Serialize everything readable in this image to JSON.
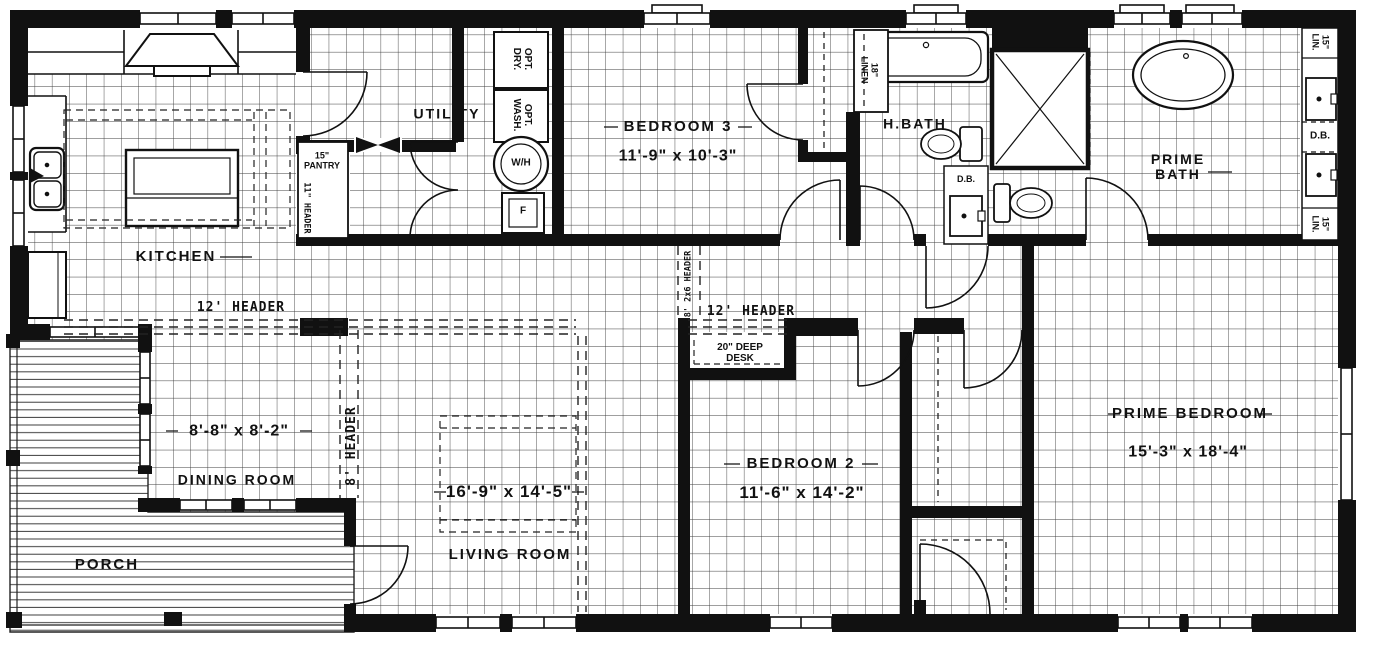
{
  "drawing": {
    "type": "manufactured-home floor plan",
    "line_color": "#1a1a1a",
    "background": "#ffffff"
  },
  "rooms": {
    "kitchen": {
      "label": "KITCHEN"
    },
    "utility": {
      "label": "UTILITY"
    },
    "bedroom_3": {
      "label": "BEDROOM 3",
      "dimensions": "11'-9\" x 10'-3\""
    },
    "hall_bath": {
      "label": "H.BATH"
    },
    "prime_bath": {
      "label": "PRIME\nBATH"
    },
    "prime_bedroom": {
      "label": "PRIME BEDROOM",
      "dimensions": "15'-3\" x 18'-4\""
    },
    "bedroom_2": {
      "label": "BEDROOM 2",
      "dimensions": "11'-6\" x 14'-2\""
    },
    "dining_room": {
      "label": "DINING ROOM",
      "dimensions": "8'-8\" x 8'-2\""
    },
    "living_room": {
      "label": "LIVING ROOM",
      "dimensions": "16'-9\" x 14'-5\""
    },
    "porch": {
      "label": "PORCH"
    }
  },
  "annotations": {
    "header_12_left": "12' HEADER",
    "header_12_right": "12' HEADER",
    "header_8": "8' HEADER",
    "header_8_2x6": "8' 2x6 HEADER",
    "header_11": "11\" HEADER",
    "pantry": "15\"\nPANTRY",
    "opt_dry": "OPT.\nDRY.",
    "opt_wash": "OPT.\nWASH.",
    "water_heater": "W/H",
    "furnace": "F",
    "desk": "20\" DEEP\nDESK",
    "linen_18": "18\"\nLINEN",
    "lin_15_top": "15\"\nLIN.",
    "lin_15_bottom": "15\"\nLIN.",
    "db_prime_vanity": "D.B.",
    "db_hall_bath": "D.B."
  }
}
